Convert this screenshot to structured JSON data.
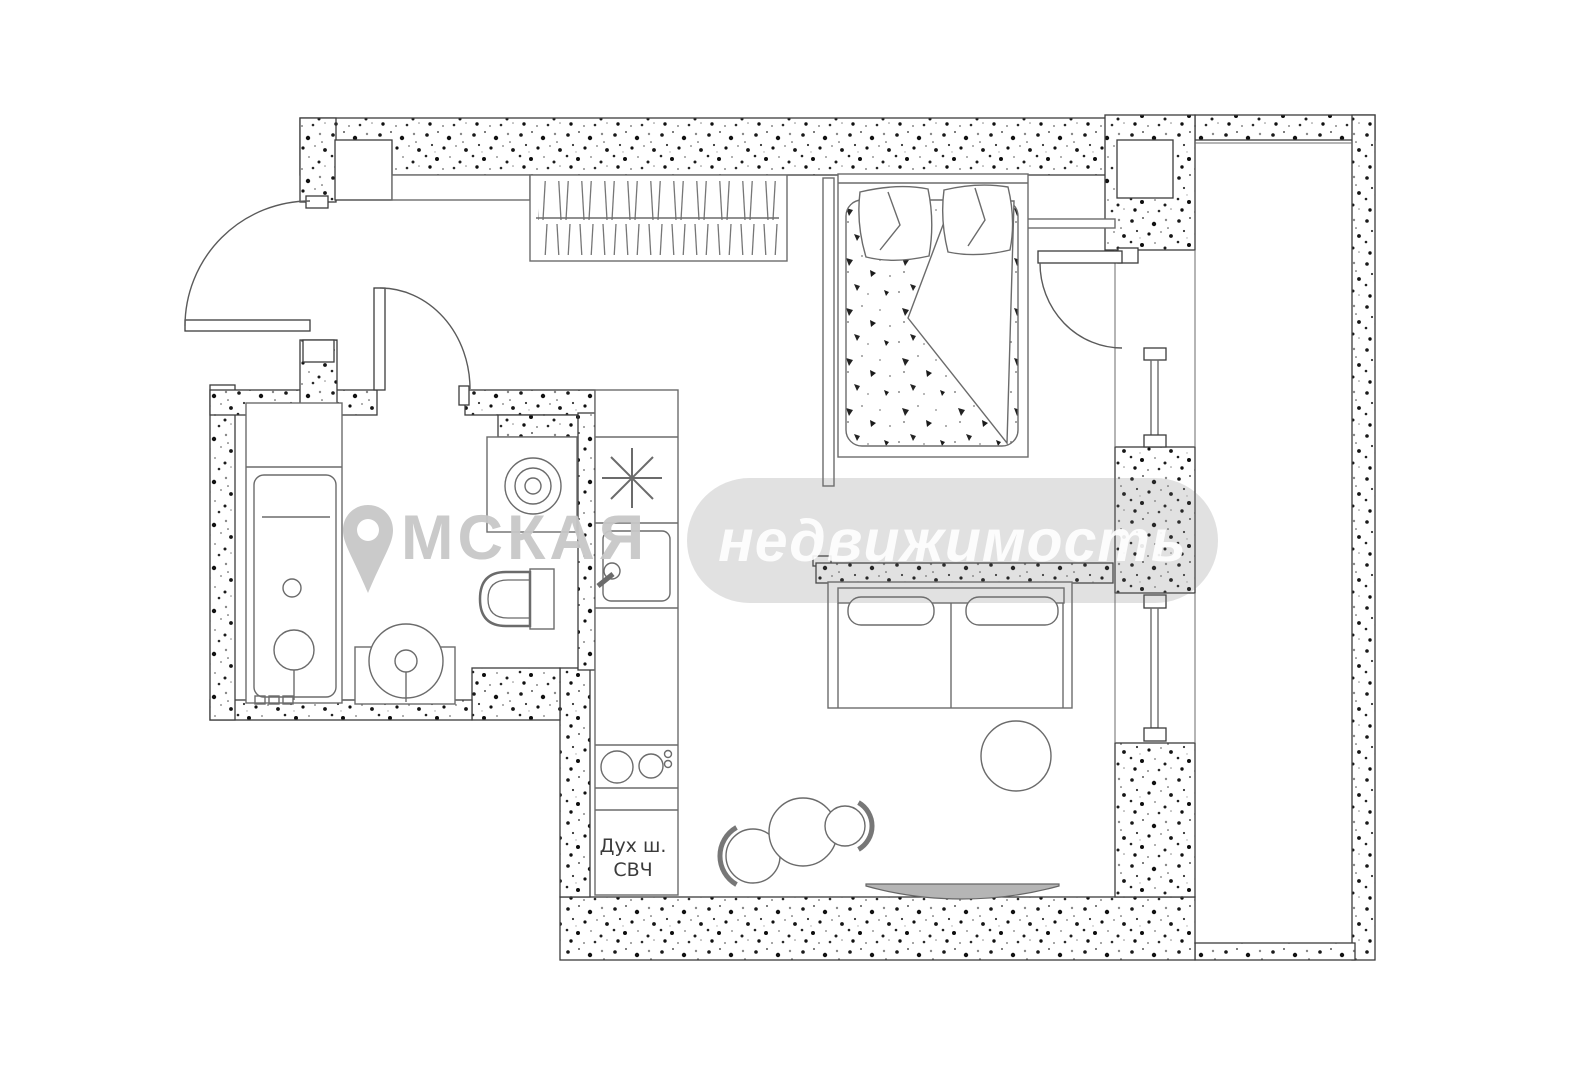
{
  "page": {
    "background": "#ffffff"
  },
  "plan": {
    "line_color": "#3c3c3c",
    "furniture_line_color": "#6b6b6b",
    "wall_fill": "speckled-concrete",
    "labels": {
      "oven": "Дух ш.",
      "microwave": "СВЧ"
    }
  },
  "watermark": {
    "pin_icon": "location-pin-icon",
    "brand_first_full": "ОМСКАЯ",
    "text_after_pin": "МСКАЯ",
    "brand_second": "недвижимость",
    "brand_color": "#c7c7c7",
    "badge_bg": "#d9d9d9",
    "badge_text_color": "#ffffff"
  },
  "icons": {
    "snowflake": "refrigerator",
    "spiral": "washing-machine-drum",
    "pin": "location-marker"
  }
}
